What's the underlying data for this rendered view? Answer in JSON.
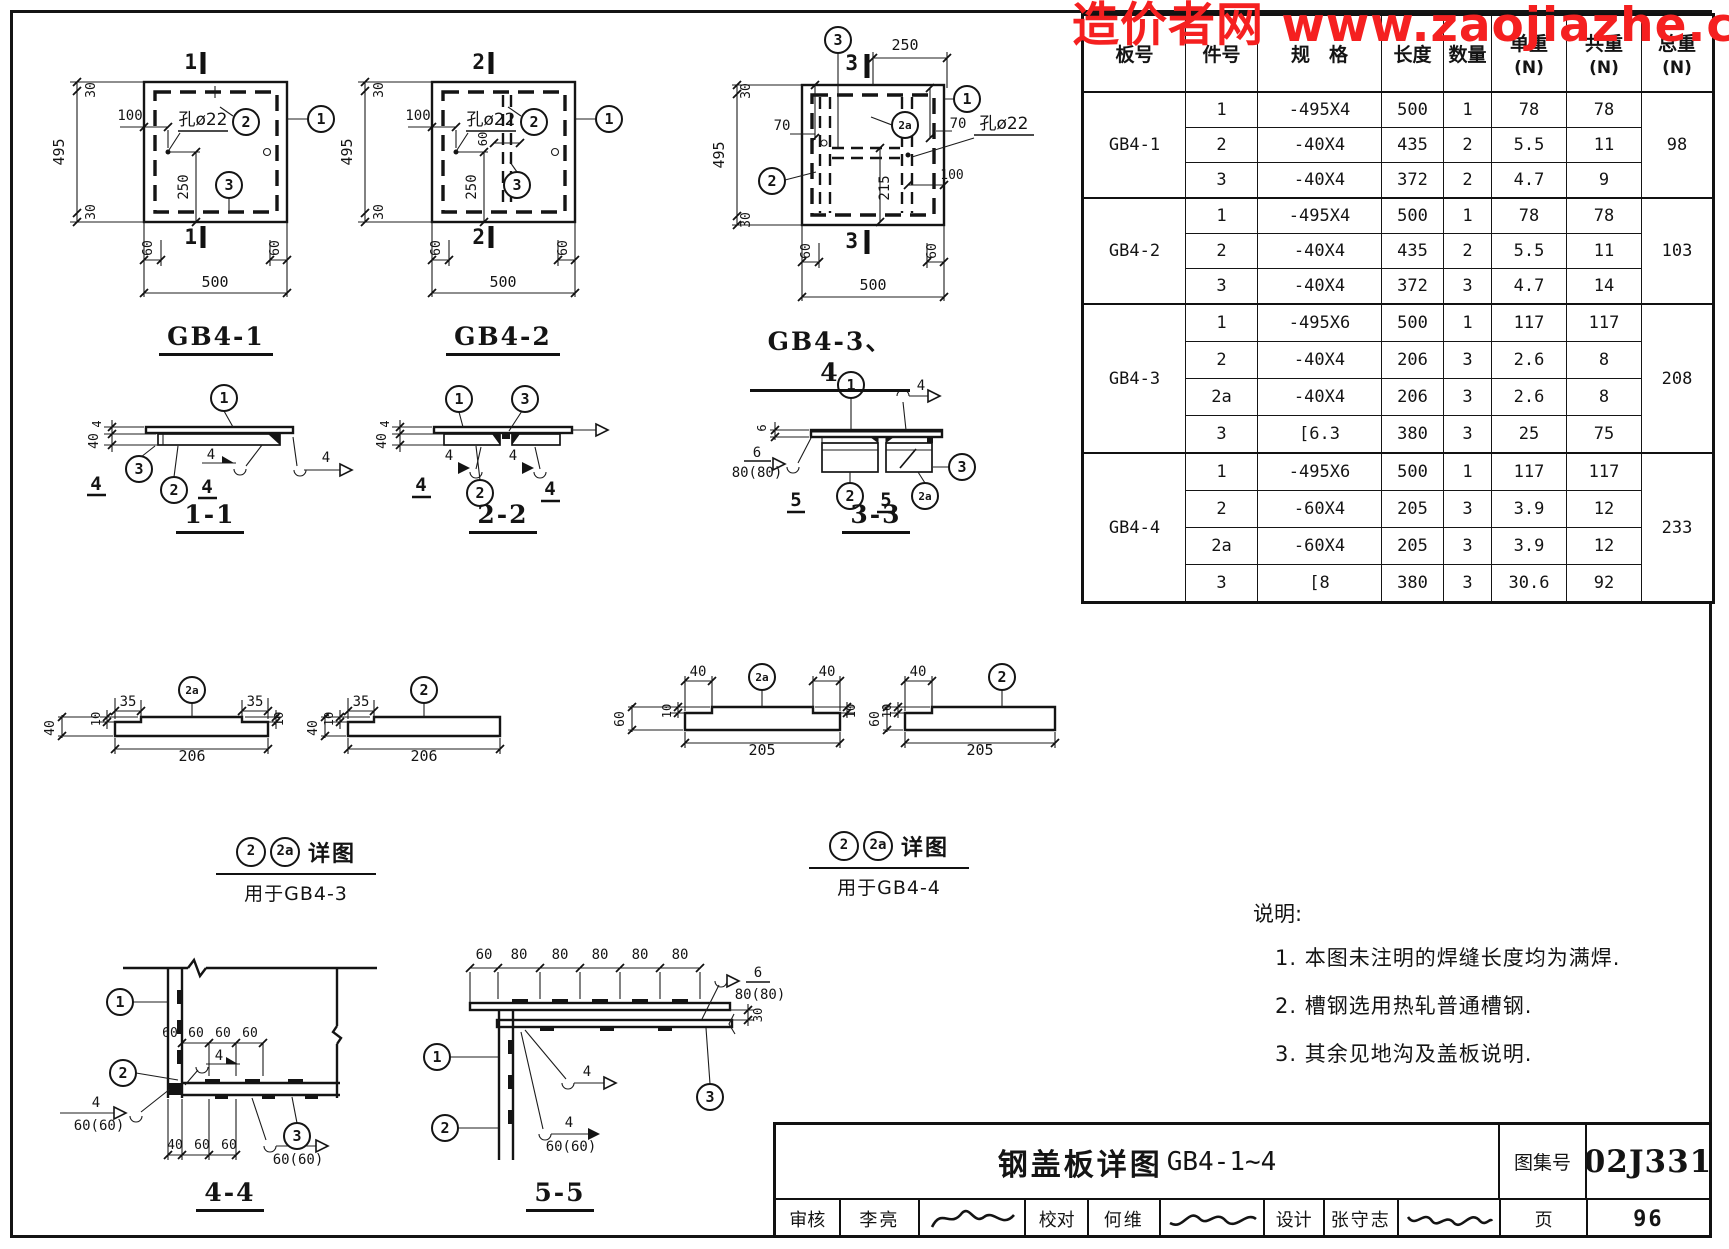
{
  "watermark": {
    "text": "造价者网 www.zaojiazhe.co",
    "color": "#f52020"
  },
  "table": {
    "headers": [
      {
        "label": "板号"
      },
      {
        "label": "件号"
      },
      {
        "label": "规　格"
      },
      {
        "label": "长度"
      },
      {
        "label": "数量"
      },
      {
        "label": "单重",
        "sub": "(N)"
      },
      {
        "label": "共重",
        "sub": "(N)"
      },
      {
        "label": "总重",
        "sub": "(N)"
      }
    ],
    "groups": [
      {
        "board": "GB4-1",
        "total": "98",
        "rows": [
          [
            "1",
            "-495X4",
            "500",
            "1",
            "78",
            "78"
          ],
          [
            "2",
            "-40X4",
            "435",
            "2",
            "5.5",
            "11"
          ],
          [
            "3",
            "-40X4",
            "372",
            "2",
            "4.7",
            "9"
          ]
        ]
      },
      {
        "board": "GB4-2",
        "total": "103",
        "rows": [
          [
            "1",
            "-495X4",
            "500",
            "1",
            "78",
            "78"
          ],
          [
            "2",
            "-40X4",
            "435",
            "2",
            "5.5",
            "11"
          ],
          [
            "3",
            "-40X4",
            "372",
            "3",
            "4.7",
            "14"
          ]
        ]
      },
      {
        "board": "GB4-3",
        "total": "208",
        "rows": [
          [
            "1",
            "-495X6",
            "500",
            "1",
            "117",
            "117"
          ],
          [
            "2",
            "-40X4",
            "206",
            "3",
            "2.6",
            "8"
          ],
          [
            "2a",
            "-40X4",
            "206",
            "3",
            "2.6",
            "8"
          ],
          [
            "3",
            "[6.3",
            "380",
            "3",
            "25",
            "75"
          ]
        ]
      },
      {
        "board": "GB4-4",
        "total": "233",
        "rows": [
          [
            "1",
            "-495X6",
            "500",
            "1",
            "117",
            "117"
          ],
          [
            "2",
            "-60X4",
            "205",
            "3",
            "3.9",
            "12"
          ],
          [
            "2a",
            "-60X4",
            "205",
            "3",
            "3.9",
            "12"
          ],
          [
            "3",
            "[8",
            "380",
            "3",
            "30.6",
            "92"
          ]
        ]
      }
    ]
  },
  "figure_titles": {
    "gb41": "GB4-1",
    "gb42": "GB4-2",
    "gb434": "GB4-3、4",
    "s11": "1-1",
    "s22": "2-2",
    "s33": "3-3",
    "s44": "4-4",
    "s55": "5-5"
  },
  "captions": [
    {
      "balloon1": "2",
      "balloon2": "2a",
      "label": "详图",
      "target": "用于GB4-3"
    },
    {
      "balloon1": "2",
      "balloon2": "2a",
      "label": "详图",
      "target": "用于GB4-4"
    }
  ],
  "notes": {
    "heading": "说明:",
    "items": [
      "1. 本图未注明的焊缝长度均为满焊.",
      "2. 槽钢选用热轧普通槽钢.",
      "3. 其余见地沟及盖板说明."
    ]
  },
  "titleblock": {
    "title": "钢盖板详图",
    "drawing_no": "GB4-1~4",
    "atlas_label": "图集号",
    "atlas_no": "02J331",
    "page_label": "页",
    "page_no": "96",
    "review_label": "审核",
    "review_name": "李亮",
    "check_label": "校对",
    "check_name": "何维",
    "design_label": "设计",
    "design_name": "张守志"
  },
  "svg_labels": [
    {
      "n": "section-mark-1-top",
      "t": "1",
      "x": 197,
      "y": 69,
      "s": 21,
      "a": "end",
      "b": 1
    },
    {
      "n": "section-mark-1-bottom",
      "t": "1",
      "x": 197,
      "y": 244,
      "s": 21,
      "a": "end",
      "b": 1
    },
    {
      "n": "dim-495",
      "t": "495",
      "x": 64,
      "y": 152,
      "r": -90,
      "s": 15
    },
    {
      "n": "dim-30-top",
      "t": "30",
      "x": 95,
      "y": 90,
      "r": -90,
      "s": 13
    },
    {
      "n": "dim-30-bottom",
      "t": "30",
      "x": 95,
      "y": 212,
      "r": -90,
      "s": 13
    },
    {
      "n": "dim-100",
      "t": "100",
      "x": 130,
      "y": 120,
      "s": 14
    },
    {
      "n": "hole-label",
      "t": "孔ø22",
      "x": 203,
      "y": 125,
      "s": 17,
      "cn": 1
    },
    {
      "n": "dim-250",
      "t": "250",
      "x": 188,
      "y": 187,
      "r": -90,
      "s": 14
    },
    {
      "n": "dim-60-left",
      "t": "60",
      "x": 152,
      "y": 248,
      "r": -90,
      "s": 13
    },
    {
      "n": "dim-60-right",
      "t": "60",
      "x": 279,
      "y": 248,
      "r": -90,
      "s": 13
    },
    {
      "n": "dim-500",
      "t": "500",
      "x": 215,
      "y": 287,
      "s": 15
    },
    {
      "n": "section-mark-2-top",
      "t": "2",
      "x": 485,
      "y": 69,
      "s": 21,
      "a": "end",
      "b": 1
    },
    {
      "n": "section-mark-2-bottom",
      "t": "2",
      "x": 485,
      "y": 244,
      "s": 21,
      "a": "end",
      "b": 1
    },
    {
      "n": "dim-495",
      "t": "495",
      "x": 352,
      "y": 152,
      "r": -90,
      "s": 15
    },
    {
      "n": "dim-30-top",
      "t": "30",
      "x": 383,
      "y": 90,
      "r": -90,
      "s": 13
    },
    {
      "n": "dim-30-bottom",
      "t": "30",
      "x": 383,
      "y": 212,
      "r": -90,
      "s": 13
    },
    {
      "n": "dim-100",
      "t": "100",
      "x": 418,
      "y": 120,
      "s": 14
    },
    {
      "n": "hole-label",
      "t": "孔ø22",
      "x": 491,
      "y": 125,
      "s": 17,
      "cn": 1
    },
    {
      "n": "dim-60-inner",
      "t": "60",
      "x": 487,
      "y": 139,
      "r": -90,
      "s": 12
    },
    {
      "n": "dim-250",
      "t": "250",
      "x": 476,
      "y": 187,
      "r": -90,
      "s": 14
    },
    {
      "n": "dim-60-left",
      "t": "60",
      "x": 440,
      "y": 248,
      "r": -90,
      "s": 13
    },
    {
      "n": "dim-60-right",
      "t": "60",
      "x": 567,
      "y": 248,
      "r": -90,
      "s": 13
    },
    {
      "n": "dim-500",
      "t": "500",
      "x": 503,
      "y": 287,
      "s": 15
    },
    {
      "n": "section-mark-3-top",
      "t": "3",
      "x": 858,
      "y": 70,
      "s": 21,
      "a": "end",
      "b": 1
    },
    {
      "n": "section-mark-3-bottom",
      "t": "3",
      "x": 858,
      "y": 248,
      "s": 21,
      "a": "end",
      "b": 1
    },
    {
      "n": "dim-250",
      "t": "250",
      "x": 905,
      "y": 50,
      "s": 15
    },
    {
      "n": "dim-495",
      "t": "495",
      "x": 724,
      "y": 155,
      "r": -90,
      "s": 15
    },
    {
      "n": "dim-30-top",
      "t": "30",
      "x": 750,
      "y": 91,
      "r": -90,
      "s": 13
    },
    {
      "n": "dim-30-bottom",
      "t": "30",
      "x": 750,
      "y": 220,
      "r": -90,
      "s": 13
    },
    {
      "n": "dim-70-left",
      "t": "70",
      "x": 782,
      "y": 130,
      "s": 14
    },
    {
      "n": "dim-70-right",
      "t": "70",
      "x": 958,
      "y": 128,
      "s": 14
    },
    {
      "n": "hole-label",
      "t": "孔ø22",
      "x": 1004,
      "y": 129,
      "s": 17,
      "cn": 1
    },
    {
      "n": "dim-215",
      "t": "215",
      "x": 889,
      "y": 188,
      "r": -90,
      "s": 14
    },
    {
      "n": "dim-100",
      "t": "100",
      "x": 952,
      "y": 179,
      "s": 13
    },
    {
      "n": "dim-60-left",
      "t": "60",
      "x": 810,
      "y": 251,
      "r": -90,
      "s": 13
    },
    {
      "n": "dim-60-right",
      "t": "60",
      "x": 936,
      "y": 251,
      "r": -90,
      "s": 13
    },
    {
      "n": "dim-500",
      "t": "500",
      "x": 873,
      "y": 290,
      "s": 15
    },
    {
      "n": "dim-4",
      "t": "4",
      "x": 101,
      "y": 424,
      "r": -90,
      "s": 12
    },
    {
      "n": "dim-40",
      "t": "40",
      "x": 98,
      "y": 441,
      "r": -90,
      "s": 13
    },
    {
      "n": "weld-size",
      "t": "4",
      "x": 211,
      "y": 459,
      "s": 14
    },
    {
      "n": "weld-size",
      "t": "4",
      "x": 326,
      "y": 462,
      "s": 14
    },
    {
      "n": "weld-ref",
      "t": "4",
      "x": 96,
      "y": 490,
      "s": 19,
      "b": 1
    },
    {
      "n": "weld-ref",
      "t": "4",
      "x": 207,
      "y": 493,
      "s": 19,
      "b": 1
    },
    {
      "n": "dim-4",
      "t": "4",
      "x": 389,
      "y": 424,
      "r": -90,
      "s": 12
    },
    {
      "n": "dim-40",
      "t": "40",
      "x": 386,
      "y": 441,
      "r": -90,
      "s": 13
    },
    {
      "n": "weld-size",
      "t": "4",
      "x": 449,
      "y": 460,
      "s": 14
    },
    {
      "n": "weld-size",
      "t": "4",
      "x": 513,
      "y": 460,
      "s": 14
    },
    {
      "n": "weld-ref",
      "t": "4",
      "x": 421,
      "y": 491,
      "s": 19,
      "b": 1
    },
    {
      "n": "weld-ref",
      "t": "4",
      "x": 550,
      "y": 495,
      "s": 19,
      "b": 1
    },
    {
      "n": "dim-6",
      "t": "6",
      "x": 766,
      "y": 428,
      "r": -90,
      "s": 12
    },
    {
      "n": "weld-size",
      "t": "4",
      "x": 921,
      "y": 390,
      "s": 14
    },
    {
      "n": "weld-size",
      "t": "6",
      "x": 757,
      "y": 457,
      "s": 14
    },
    {
      "n": "weld-length",
      "t": "80(80)",
      "x": 757,
      "y": 477,
      "s": 14
    },
    {
      "n": "weld-ref",
      "t": "5",
      "x": 796,
      "y": 506,
      "s": 19,
      "b": 1
    },
    {
      "n": "weld-ref",
      "t": "5",
      "x": 886,
      "y": 506,
      "s": 19,
      "b": 1
    },
    {
      "n": "dim-35",
      "t": "35",
      "x": 128,
      "y": 706,
      "s": 14
    },
    {
      "n": "dim-35",
      "t": "35",
      "x": 255,
      "y": 706,
      "s": 14
    },
    {
      "n": "dim-10",
      "t": "10",
      "x": 100,
      "y": 719,
      "r": -90,
      "s": 12
    },
    {
      "n": "dim-10",
      "t": "10",
      "x": 283,
      "y": 719,
      "r": -90,
      "s": 12
    },
    {
      "n": "dim-40",
      "t": "40",
      "x": 54,
      "y": 728,
      "r": -90,
      "s": 13
    },
    {
      "n": "dim-206",
      "t": "206",
      "x": 192,
      "y": 761,
      "s": 15
    },
    {
      "n": "dim-35",
      "t": "35",
      "x": 361,
      "y": 706,
      "s": 14
    },
    {
      "n": "dim-10",
      "t": "10",
      "x": 333,
      "y": 719,
      "r": -90,
      "s": 12
    },
    {
      "n": "dim-40",
      "t": "40",
      "x": 317,
      "y": 728,
      "r": -90,
      "s": 13
    },
    {
      "n": "dim-206",
      "t": "206",
      "x": 424,
      "y": 761,
      "s": 15
    },
    {
      "n": "dim-40",
      "t": "40",
      "x": 698,
      "y": 676,
      "s": 14
    },
    {
      "n": "dim-40",
      "t": "40",
      "x": 827,
      "y": 676,
      "s": 14
    },
    {
      "n": "dim-10",
      "t": "10",
      "x": 671,
      "y": 711,
      "r": -90,
      "s": 12
    },
    {
      "n": "dim-10",
      "t": "10",
      "x": 855,
      "y": 711,
      "r": -90,
      "s": 12
    },
    {
      "n": "dim-60",
      "t": "60",
      "x": 624,
      "y": 719,
      "r": -90,
      "s": 13
    },
    {
      "n": "dim-205",
      "t": "205",
      "x": 762,
      "y": 755,
      "s": 15
    },
    {
      "n": "dim-40",
      "t": "40",
      "x": 918,
      "y": 676,
      "s": 14
    },
    {
      "n": "dim-10",
      "t": "10",
      "x": 891,
      "y": 711,
      "r": -90,
      "s": 12
    },
    {
      "n": "dim-60",
      "t": "60",
      "x": 879,
      "y": 719,
      "r": -90,
      "s": 13
    },
    {
      "n": "dim-205",
      "t": "205",
      "x": 980,
      "y": 755,
      "s": 15
    },
    {
      "n": "dim-60",
      "t": "60",
      "x": 170,
      "y": 1037,
      "s": 13
    },
    {
      "n": "dim-60",
      "t": "60",
      "x": 196,
      "y": 1037,
      "s": 13
    },
    {
      "n": "dim-60",
      "t": "60",
      "x": 223,
      "y": 1037,
      "s": 13
    },
    {
      "n": "dim-60",
      "t": "60",
      "x": 250,
      "y": 1037,
      "s": 13
    },
    {
      "n": "weld-size",
      "t": "4",
      "x": 219,
      "y": 1060,
      "s": 14
    },
    {
      "n": "weld-size",
      "t": "4",
      "x": 96,
      "y": 1107,
      "s": 14
    },
    {
      "n": "weld-length",
      "t": "60(60)",
      "x": 99,
      "y": 1130,
      "s": 14
    },
    {
      "n": "dim-40",
      "t": "40",
      "x": 175,
      "y": 1149,
      "s": 13
    },
    {
      "n": "dim-60",
      "t": "60",
      "x": 202,
      "y": 1149,
      "s": 13
    },
    {
      "n": "dim-60",
      "t": "60",
      "x": 229,
      "y": 1149,
      "s": 13
    },
    {
      "n": "weld-size",
      "t": "4",
      "x": 296,
      "y": 1141,
      "s": 14
    },
    {
      "n": "weld-length",
      "t": "60(60)",
      "x": 298,
      "y": 1164,
      "s": 14
    },
    {
      "n": "dim-60",
      "t": "60",
      "x": 484,
      "y": 959,
      "s": 14
    },
    {
      "n": "dim-80",
      "t": "80",
      "x": 519,
      "y": 959,
      "s": 14
    },
    {
      "n": "dim-80",
      "t": "80",
      "x": 560,
      "y": 959,
      "s": 14
    },
    {
      "n": "dim-80",
      "t": "80",
      "x": 600,
      "y": 959,
      "s": 14
    },
    {
      "n": "dim-80",
      "t": "80",
      "x": 640,
      "y": 959,
      "s": 14
    },
    {
      "n": "dim-80",
      "t": "80",
      "x": 680,
      "y": 959,
      "s": 14
    },
    {
      "n": "weld-size",
      "t": "6",
      "x": 758,
      "y": 977,
      "s": 14
    },
    {
      "n": "weld-length",
      "t": "80(80)",
      "x": 760,
      "y": 999,
      "s": 14
    },
    {
      "n": "dim-30",
      "t": "30",
      "x": 762,
      "y": 1015,
      "r": -90,
      "s": 12
    },
    {
      "n": "weld-size",
      "t": "4",
      "x": 587,
      "y": 1076,
      "s": 14
    },
    {
      "n": "weld-size",
      "t": "4",
      "x": 569,
      "y": 1127,
      "s": 14
    },
    {
      "n": "weld-length",
      "t": "60(60)",
      "x": 571,
      "y": 1151,
      "s": 14
    }
  ],
  "balloons": [
    {
      "t": "2",
      "x": 246,
      "y": 122
    },
    {
      "t": "3",
      "x": 229,
      "y": 185
    },
    {
      "t": "1",
      "x": 321,
      "y": 119
    },
    {
      "t": "2",
      "x": 534,
      "y": 122
    },
    {
      "t": "3",
      "x": 517,
      "y": 185
    },
    {
      "t": "1",
      "x": 609,
      "y": 119
    },
    {
      "t": "3",
      "x": 838,
      "y": 40
    },
    {
      "t": "2a",
      "x": 905,
      "y": 125
    },
    {
      "t": "2",
      "x": 772,
      "y": 181
    },
    {
      "t": "1",
      "x": 967,
      "y": 99
    },
    {
      "t": "1",
      "x": 224,
      "y": 398
    },
    {
      "t": "3",
      "x": 139,
      "y": 469
    },
    {
      "t": "2",
      "x": 174,
      "y": 490
    },
    {
      "t": "1",
      "x": 459,
      "y": 399
    },
    {
      "t": "3",
      "x": 525,
      "y": 399
    },
    {
      "t": "2",
      "x": 480,
      "y": 493
    },
    {
      "t": "1",
      "x": 851,
      "y": 385
    },
    {
      "t": "2",
      "x": 850,
      "y": 496
    },
    {
      "t": "2a",
      "x": 925,
      "y": 496
    },
    {
      "t": "3",
      "x": 962,
      "y": 467
    },
    {
      "t": "2a",
      "x": 192,
      "y": 690
    },
    {
      "t": "2",
      "x": 424,
      "y": 690
    },
    {
      "t": "2a",
      "x": 762,
      "y": 677
    },
    {
      "t": "2",
      "x": 1002,
      "y": 677
    },
    {
      "t": "1",
      "x": 120,
      "y": 1002
    },
    {
      "t": "2",
      "x": 123,
      "y": 1073
    },
    {
      "t": "3",
      "x": 297,
      "y": 1136
    },
    {
      "t": "1",
      "x": 437,
      "y": 1057
    },
    {
      "t": "2",
      "x": 445,
      "y": 1128
    },
    {
      "t": "3",
      "x": 710,
      "y": 1097
    }
  ]
}
